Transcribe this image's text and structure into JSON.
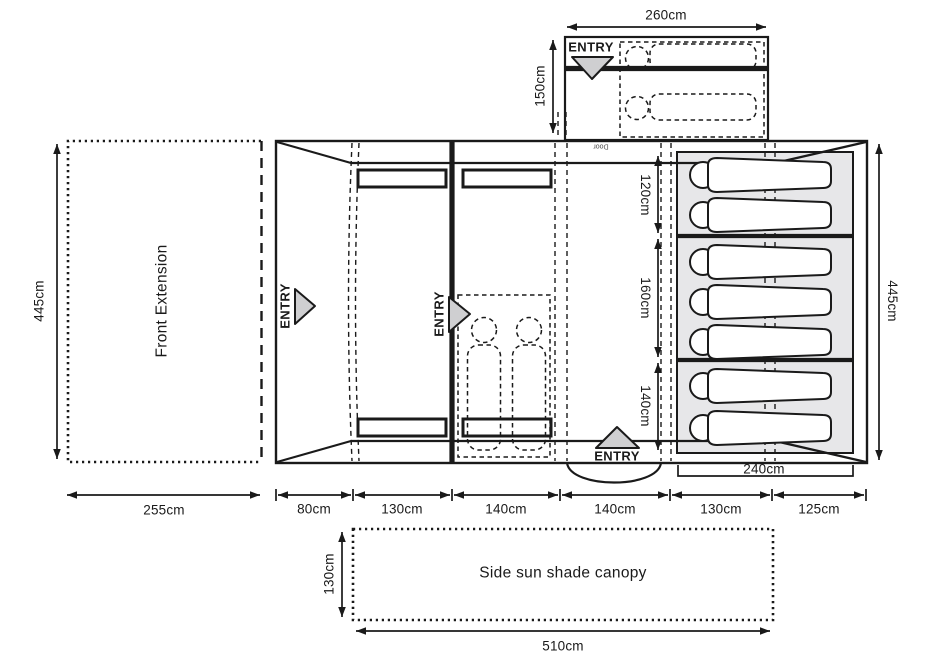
{
  "colors": {
    "line": "#1a1a1a",
    "triangle_fill": "#cfcfd1",
    "mat_fill": "#e7e7e9"
  },
  "annex": {
    "entry": "ENTRY",
    "door": "Door",
    "width": "260cm",
    "depth": "150cm"
  },
  "front_extension": {
    "name": "Front Extension",
    "height": "445cm",
    "width": "255cm"
  },
  "tent": {
    "entry_side": "ENTRY",
    "entry_inner": "ENTRY",
    "entry_front": "ENTRY",
    "height": "445cm",
    "bedroom_width": "240cm",
    "bedroom_sections": [
      "120cm",
      "160cm",
      "140cm"
    ],
    "floor_sections": [
      "80cm",
      "130cm",
      "140cm",
      "140cm",
      "130cm",
      "125cm"
    ]
  },
  "canopy": {
    "name": "Side sun shade canopy",
    "depth": "130cm",
    "width": "510cm"
  }
}
